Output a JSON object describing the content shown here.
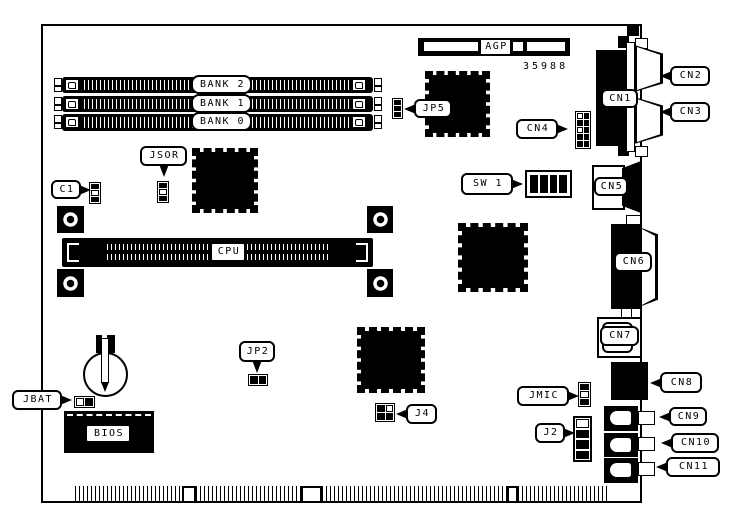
{
  "diagram": {
    "part_number": "35988",
    "slots": {
      "agp": "AGP",
      "bank2": "BANK 2",
      "bank1": "BANK 1",
      "bank0": "BANK 0",
      "cpu": "CPU",
      "bios": "BIOS"
    },
    "connectors": {
      "cn1": "CN1",
      "cn2": "CN2",
      "cn3": "CN3",
      "cn4": "CN4",
      "cn5": "CN5",
      "cn6": "CN6",
      "cn7": "CN7",
      "cn8": "CN8",
      "cn9": "CN9",
      "cn10": "CN10",
      "cn11": "CN11"
    },
    "jumpers_switches": {
      "jp5": "JP5",
      "jp2": "JP2",
      "jsor": "JSOR",
      "jbat": "JBAT",
      "jmic": "JMIC",
      "j2": "J2",
      "j4": "J4",
      "sw1": "SW 1",
      "c1": "C1"
    },
    "colors": {
      "line": "#000000",
      "background": "#ffffff"
    }
  }
}
